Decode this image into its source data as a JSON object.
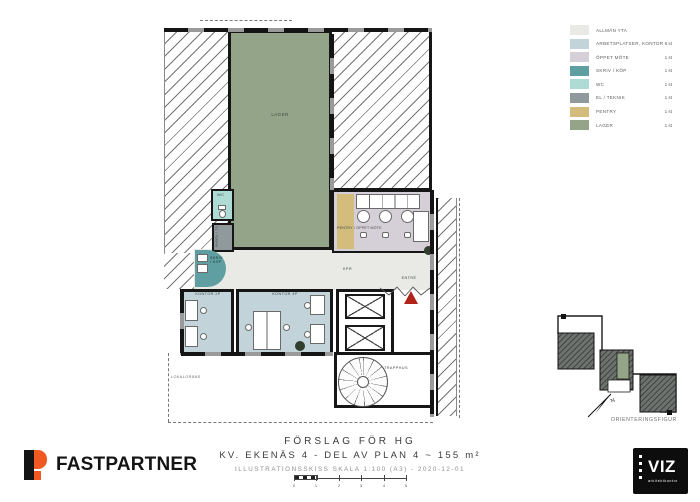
{
  "legend": {
    "items": [
      {
        "label": "ALLMÄN YTA",
        "count": "",
        "color": "#e9eae6"
      },
      {
        "label": "ARBETSPLATSER, KONTOR",
        "count": "6 st",
        "color": "#c2d4da"
      },
      {
        "label": "ÖPPET MÖTE",
        "count": "1 st",
        "color": "#d5cfd8"
      },
      {
        "label": "SKRIV / KÖP",
        "count": "1 st",
        "color": "#5f9fa1"
      },
      {
        "label": "WC",
        "count": "1 st",
        "color": "#aedbd4"
      },
      {
        "label": "EL / TEKNIK",
        "count": "1 st",
        "color": "#90999b"
      },
      {
        "label": "PENTRY",
        "count": "1 st",
        "color": "#d4bc7d"
      },
      {
        "label": "LAGER",
        "count": "1 st",
        "color": "#93a489"
      }
    ]
  },
  "plan": {
    "rooms": {
      "lager": "LAGER",
      "pentry_oppet_mote": "PENTRY / ÖPPET MÖTE",
      "skriv_kop_line1": "SKRIV",
      "skriv_kop_line2": "/ KÖP",
      "wc": "WC",
      "el_teknik": "EL / TEKNIK",
      "kontor_2p": "KONTOR 2P",
      "kontor_4p": "KONTOR 4P",
      "kpr": "KPR",
      "entre": "ENTRÉ",
      "trapphus": "TRAPPHUS",
      "boundary": "LOKALGRÄNS"
    }
  },
  "orientation": {
    "north": "N",
    "caption": "ORIENTERINGSFIGUR"
  },
  "title_block": {
    "line1": "FÖRSLAG FÖR HG",
    "line2": "KV. EKENÄS 4 - DEL AV PLAN 4 ~ 155 m²",
    "line3": "ILLUSTRATIONSSKISS SKALA 1:100 (A3) - 2020-12-01",
    "scale_ticks": [
      "0",
      "1",
      "2",
      "3",
      "4",
      "5"
    ]
  },
  "branding": {
    "fastpartner": "FASTPARTNER",
    "viz": "VIZ",
    "viz_sub": "arkitektkontor"
  }
}
